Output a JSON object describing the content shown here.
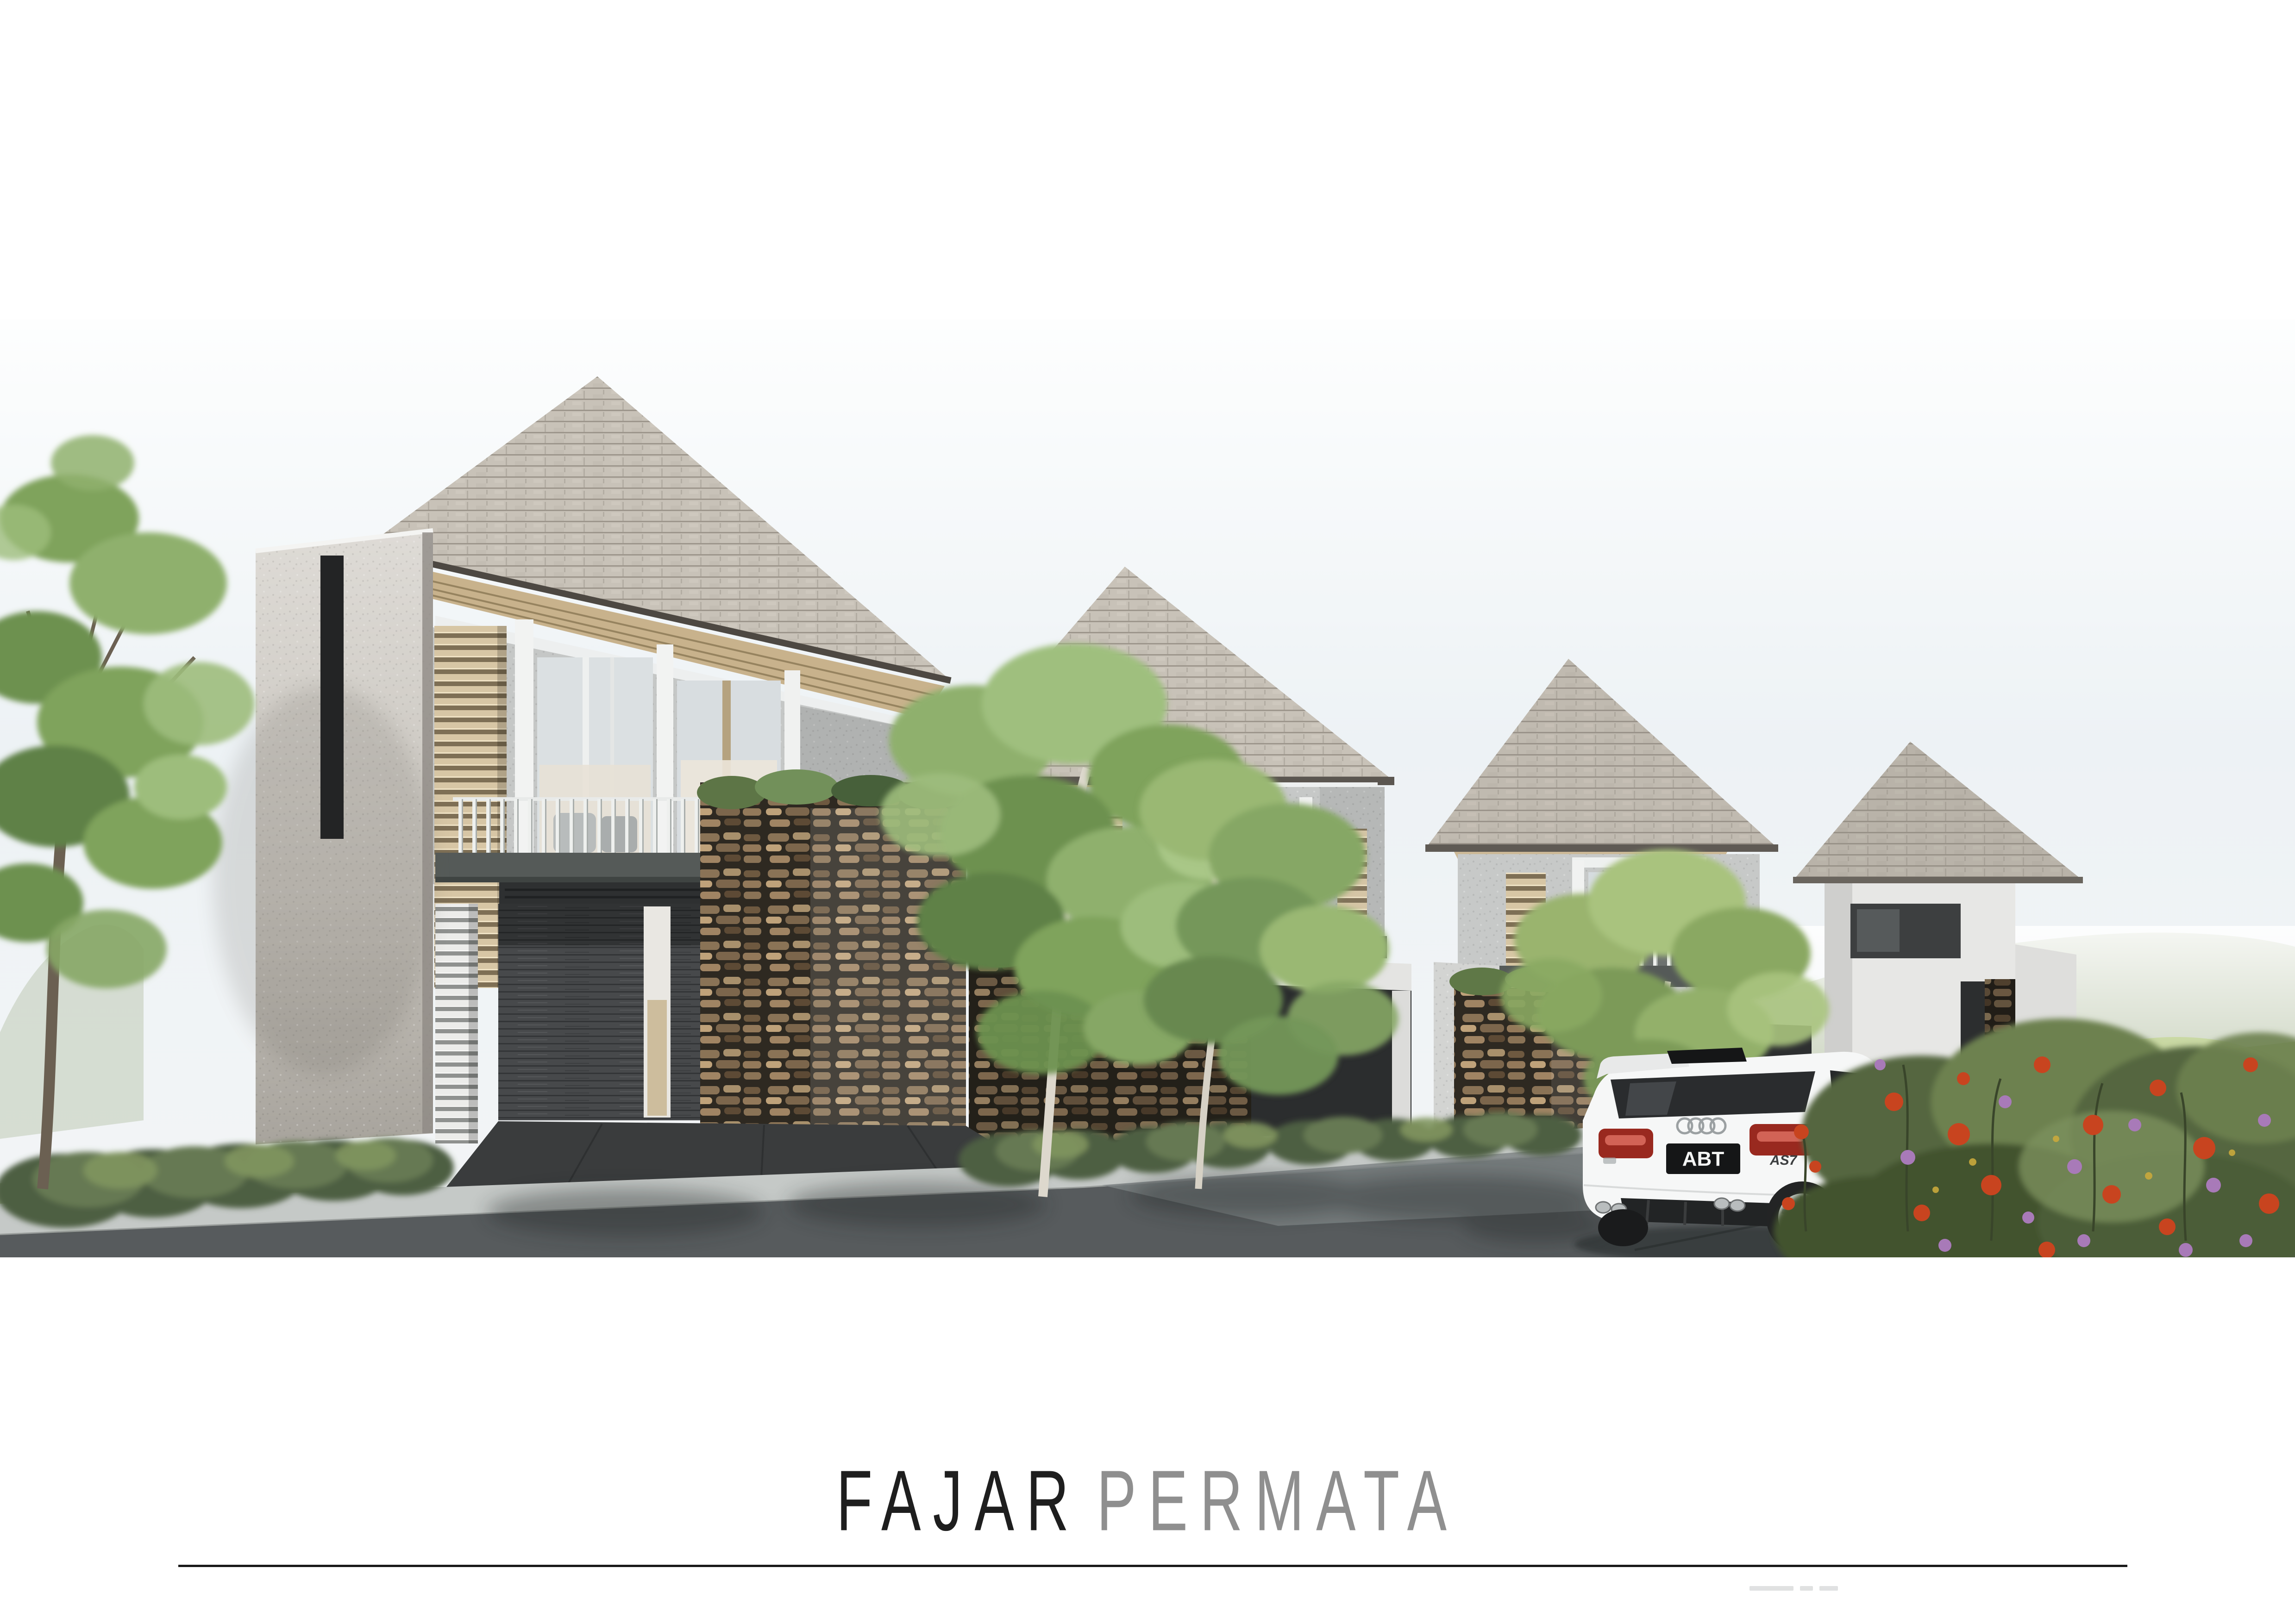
{
  "page": {
    "type": "architectural-presentation-board",
    "background": "#ffffff"
  },
  "title": {
    "primary": "FAJAR",
    "secondary": "PERMATA"
  },
  "title_colors": {
    "primary": "#1e1e1e",
    "secondary": "#8f8f8f"
  },
  "divider_color": "#1a1a1a",
  "vehicle": {
    "plate": "ABT",
    "badge": "AS7",
    "brand_icon": "audi-rings-icon"
  },
  "scene": {
    "houses_count": "4"
  },
  "colors": {
    "sky_top": "#fdfefe",
    "sky_mid": "#edf2f5",
    "roof_shingle": "#c8c2b8",
    "facade": "#c6c8c7",
    "concrete_wall": "#d8d5cf",
    "louver_wood": "#d7c6a5",
    "slab_dark": "#555a58",
    "slate_wall": "#47494b",
    "stone_dark": "#2e2921",
    "stone_light": "#a8906c",
    "driveway": "#3a3c3d",
    "sidewalk": "#c5c9c7",
    "asphalt": "#575b5d",
    "asphalt_light": "#7d8385",
    "hill_far": "#c2ccb4",
    "cliff": "#cdc0a5",
    "meadow": "#aabf7f",
    "foliage_light": "#9dbd7c",
    "foliage_mid": "#7fa35c",
    "foliage_dark": "#5f8147",
    "trunk_light": "#ddd8cd",
    "trunk_brown": "#6b6052",
    "flower_red": "#c8441f",
    "flower_purple": "#a87ab8",
    "car_body": "#f6f7f7",
    "taillight": "#99291f"
  }
}
